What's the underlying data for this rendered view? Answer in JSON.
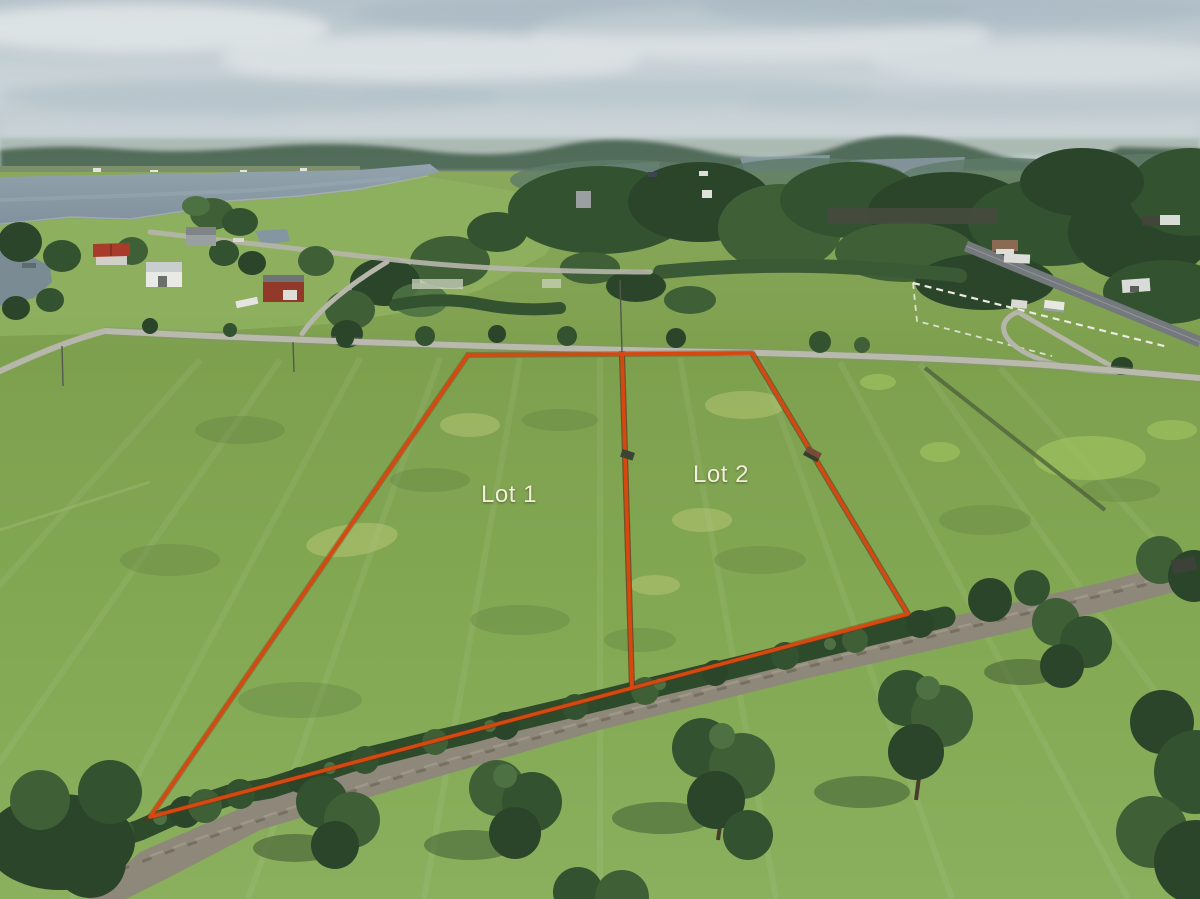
{
  "scene": {
    "type": "aerial-drone-photo",
    "subject": "Two surveyed residential lots outlined in red on an open green pasture beside a gravel tree-lined lane, with a river, waterfront homes, country roads and forest in the background under an overcast sky"
  },
  "annotations": {
    "boundary_color": "#d6480f",
    "label_color": "#f2eeda",
    "lots": [
      {
        "label": "Lot 1"
      },
      {
        "label": "Lot 2"
      }
    ]
  }
}
